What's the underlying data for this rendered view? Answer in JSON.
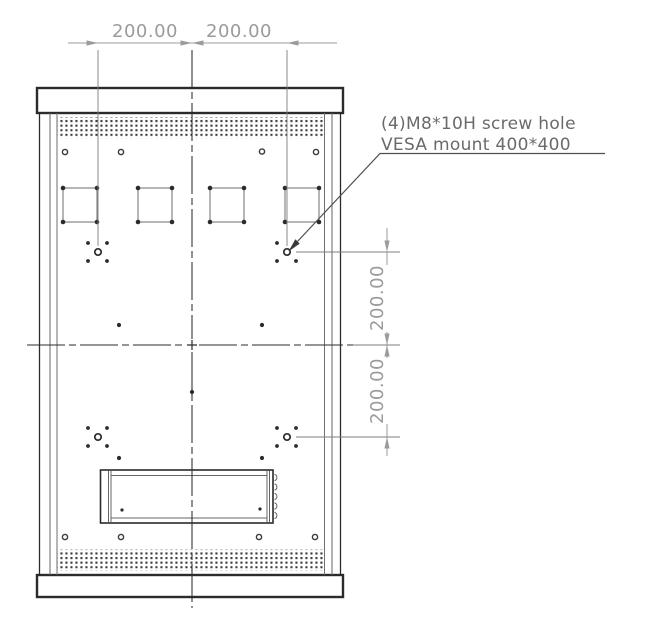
{
  "drawing": {
    "title": "VESA mount rear-panel drawing",
    "dimensions": {
      "top_left": "200.00",
      "top_right": "200.00",
      "right_upper": "200.00",
      "right_lower": "200.00"
    },
    "annotation": {
      "line1": "(4)M8*10H screw hole",
      "line2": "VESA mount 400*400"
    },
    "colors": {
      "line_dark": "#2b2b2b",
      "line_medium": "#666666",
      "dimension_gray": "#9b9b9b",
      "annotation_gray": "#6a6a6a",
      "leader_gray": "#4f4f4f"
    }
  }
}
